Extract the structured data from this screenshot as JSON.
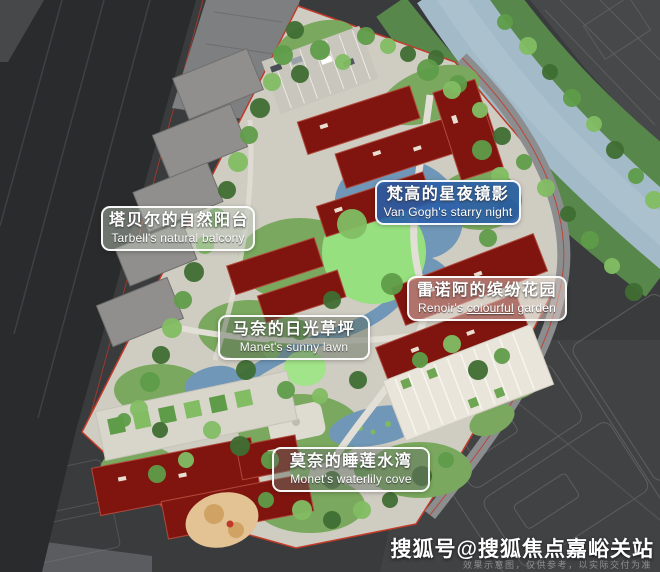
{
  "labels": [
    {
      "id": "tarbell",
      "zh": "塔贝尔的自然阳台",
      "en_pre": "Tarbell's natural balcony",
      "en_underline": "",
      "en_post": ""
    },
    {
      "id": "vangogh",
      "zh": "梵高的星夜镜影",
      "en_pre": "Van Gogh's starry night",
      "en_underline": "",
      "en_post": ""
    },
    {
      "id": "renoir",
      "zh": "雷诺阿的缤纷花园",
      "en_pre": "Renoir's ",
      "en_underline": "colourful",
      "en_post": " garden"
    },
    {
      "id": "manet",
      "zh": "马奈的日光草坪",
      "en_pre": "Manet's sunny lawn",
      "en_underline": "",
      "en_post": ""
    },
    {
      "id": "monet",
      "zh": "莫奈的睡莲水湾",
      "en_pre": "Monet's waterlily cove",
      "en_underline": "",
      "en_post": ""
    }
  ],
  "watermark": {
    "account": "搜狐号@搜狐焦点嘉峪关站",
    "disclaimer": "效果示意图，仅供参考，以实际交付为准"
  },
  "colors": {
    "site_paving": "#cfccc2",
    "building_maroon": "#7f150e",
    "lawn_green": "#97e07f",
    "pond_blue": "#7097b7",
    "river_blue": "#a3bac8",
    "boundary_red": "#c23b2a",
    "label_blue_bg": "#2a5ea8",
    "city_dark": "#3a3b3d"
  }
}
